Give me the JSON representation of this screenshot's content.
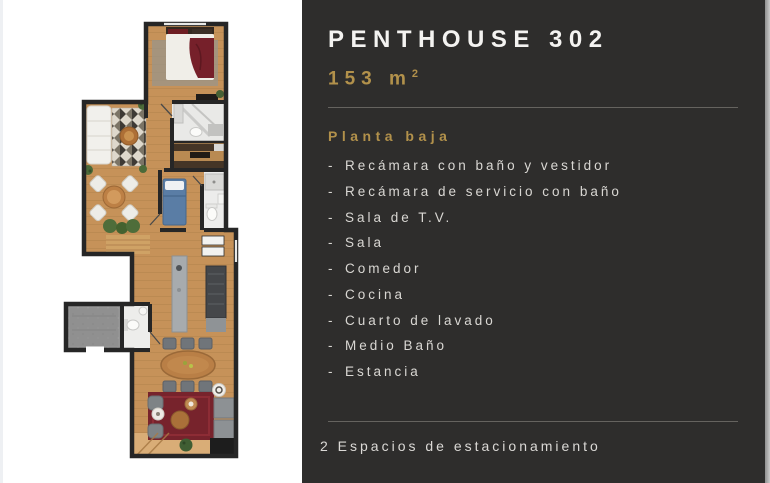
{
  "panel": {
    "title": "PENTHOUSE 302",
    "area_value": "153",
    "area_unit": "m",
    "area_exponent": "2",
    "section_heading": "Planta baja",
    "bullet": "-",
    "features": [
      "Recámara con baño y vestidor",
      "Recámara de servicio con baño",
      "Sala de T.V.",
      "Sala",
      "Comedor",
      "Cocina",
      "Cuarto de lavado",
      "Medio Baño",
      "Estancia"
    ],
    "footer": "2 Espacios de estacionamiento",
    "colors": {
      "background": "#2e2d2c",
      "accent_gold": "#b2914b",
      "title_text": "#f4f3f1",
      "body_text": "#d9d7d3",
      "divider": "#65635f"
    }
  }
}
